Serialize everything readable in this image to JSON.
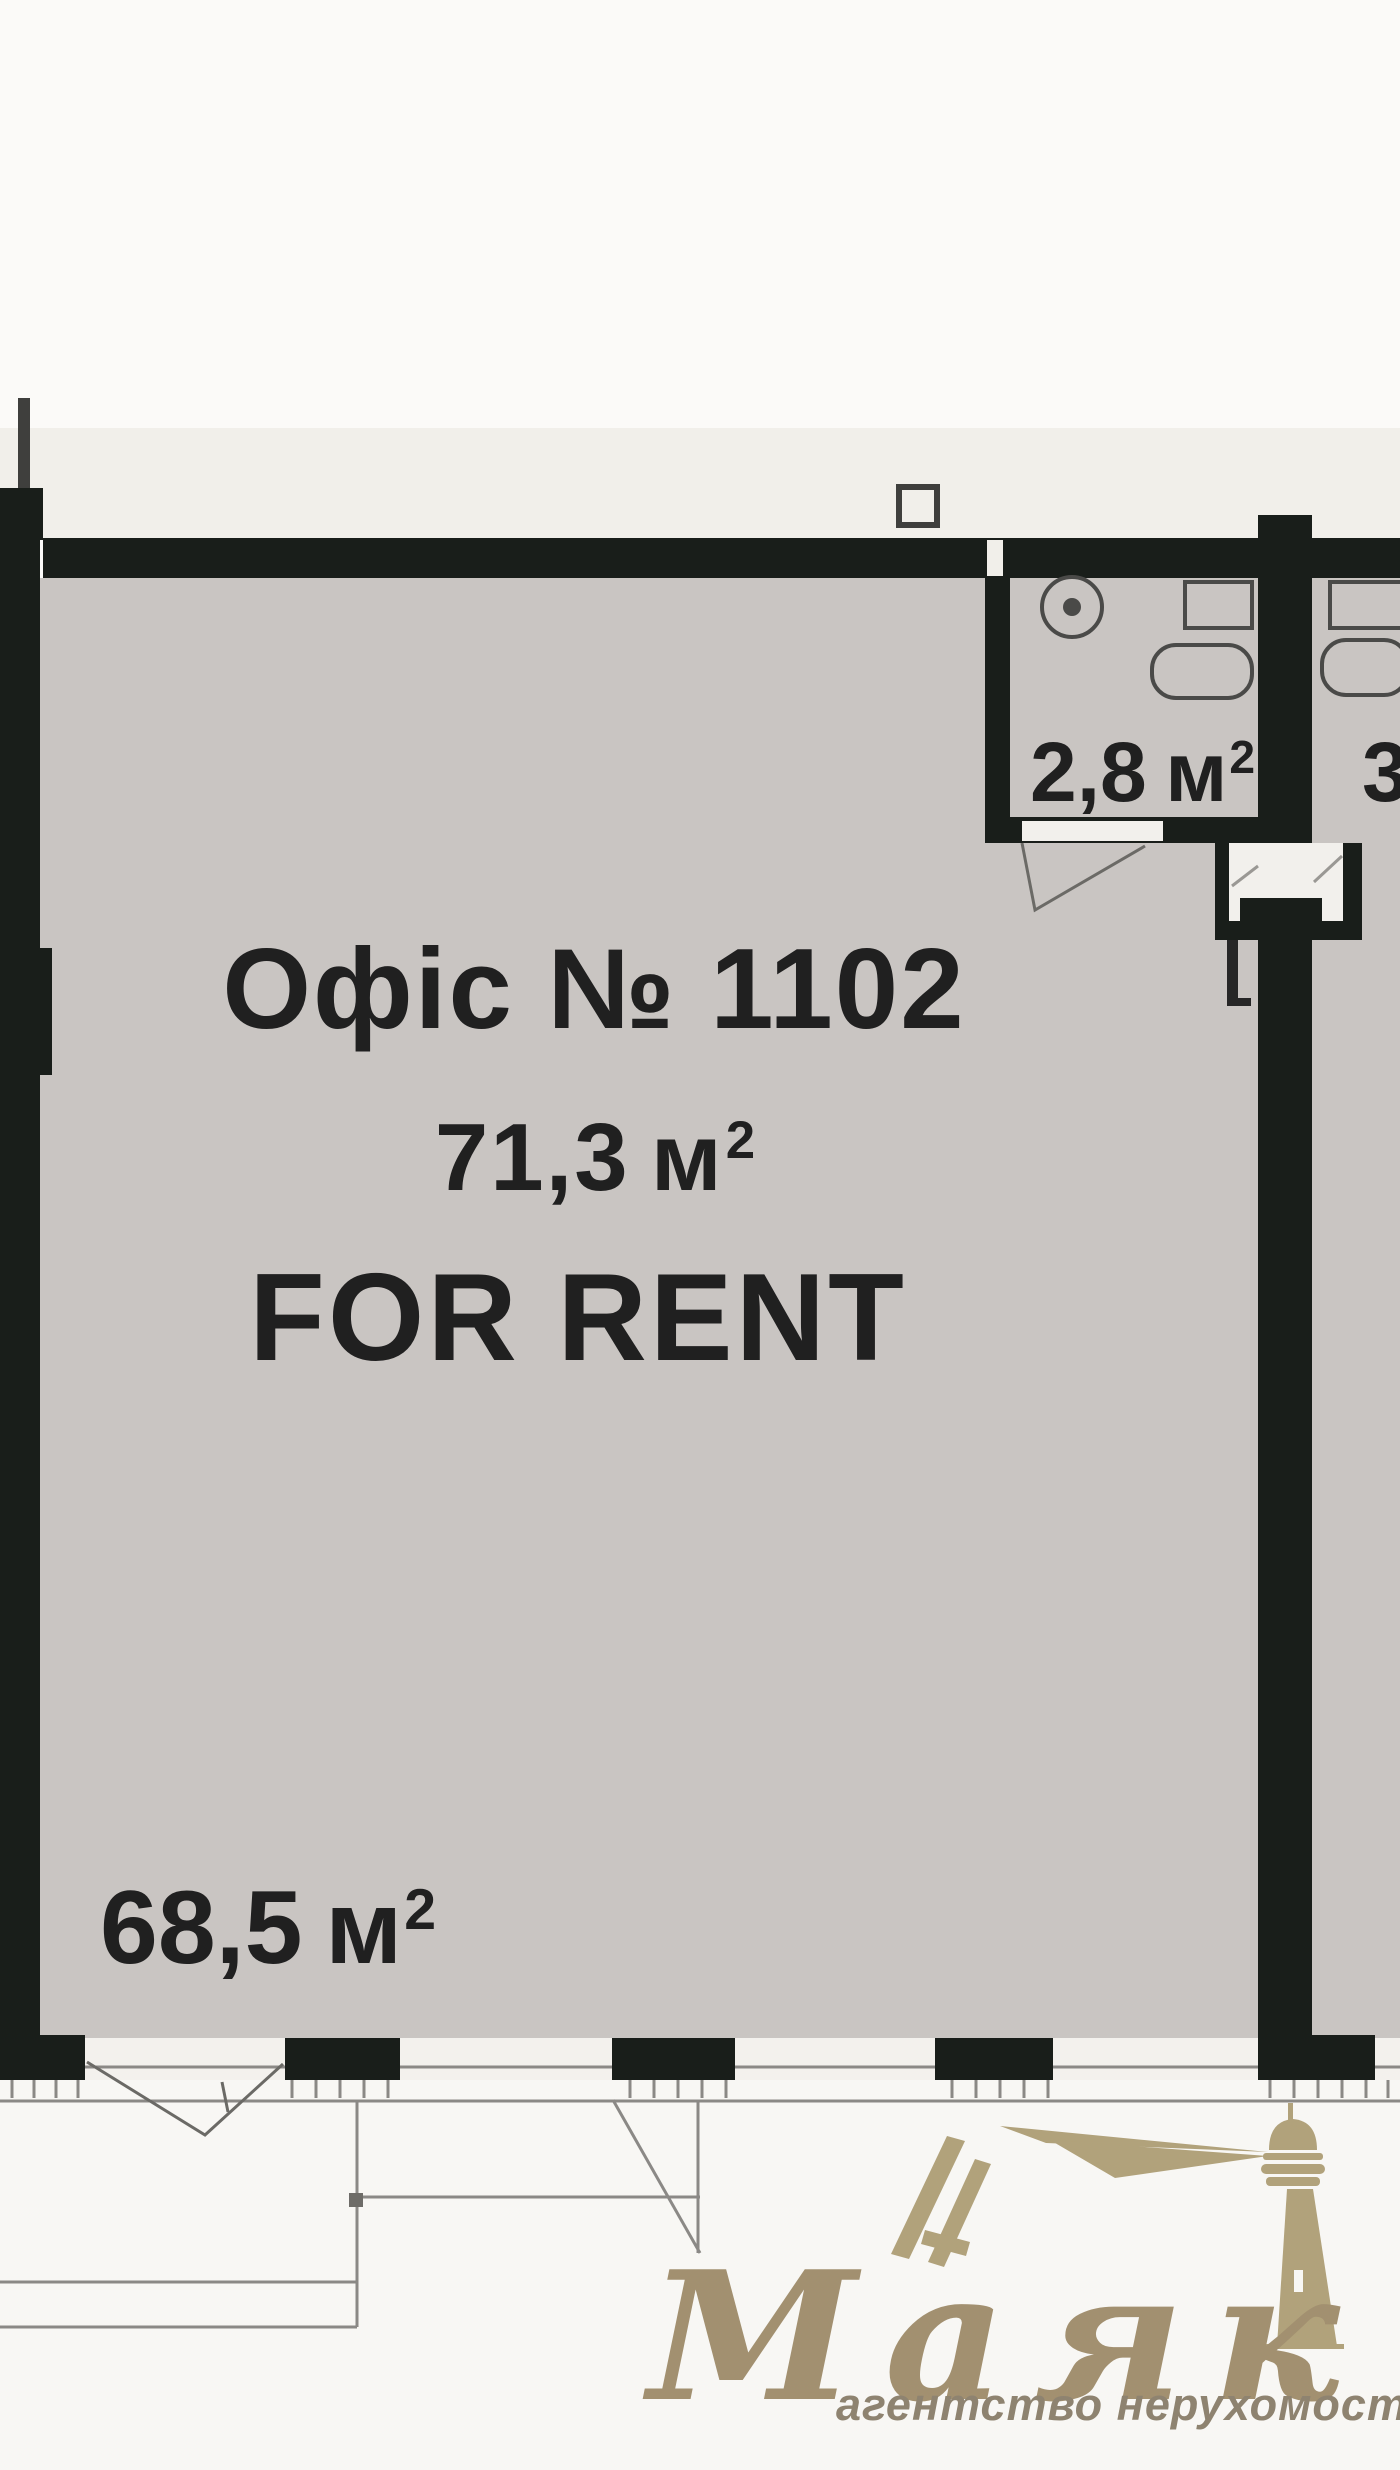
{
  "floorplan": {
    "office_title": "Офіс № 1102",
    "office_area_value": "71,3",
    "area_unit": "м",
    "area_exponent": "2",
    "for_rent_label": "FOR RENT",
    "bathroom_area_value": "2,8",
    "adjacent_area_value": "3",
    "main_room_area_value": "68,5"
  },
  "watermark": {
    "brand_name": "Маяк",
    "tagline": "агентство нерухомості"
  },
  "colors": {
    "wall": "#191e1a",
    "room_fill": "#c9c5c2",
    "paper_band": "#f1efea",
    "page_background": "#fbfaf8",
    "label_text": "#202020",
    "brand_gold": "#a29070",
    "pencil_line": "#8b8986"
  }
}
